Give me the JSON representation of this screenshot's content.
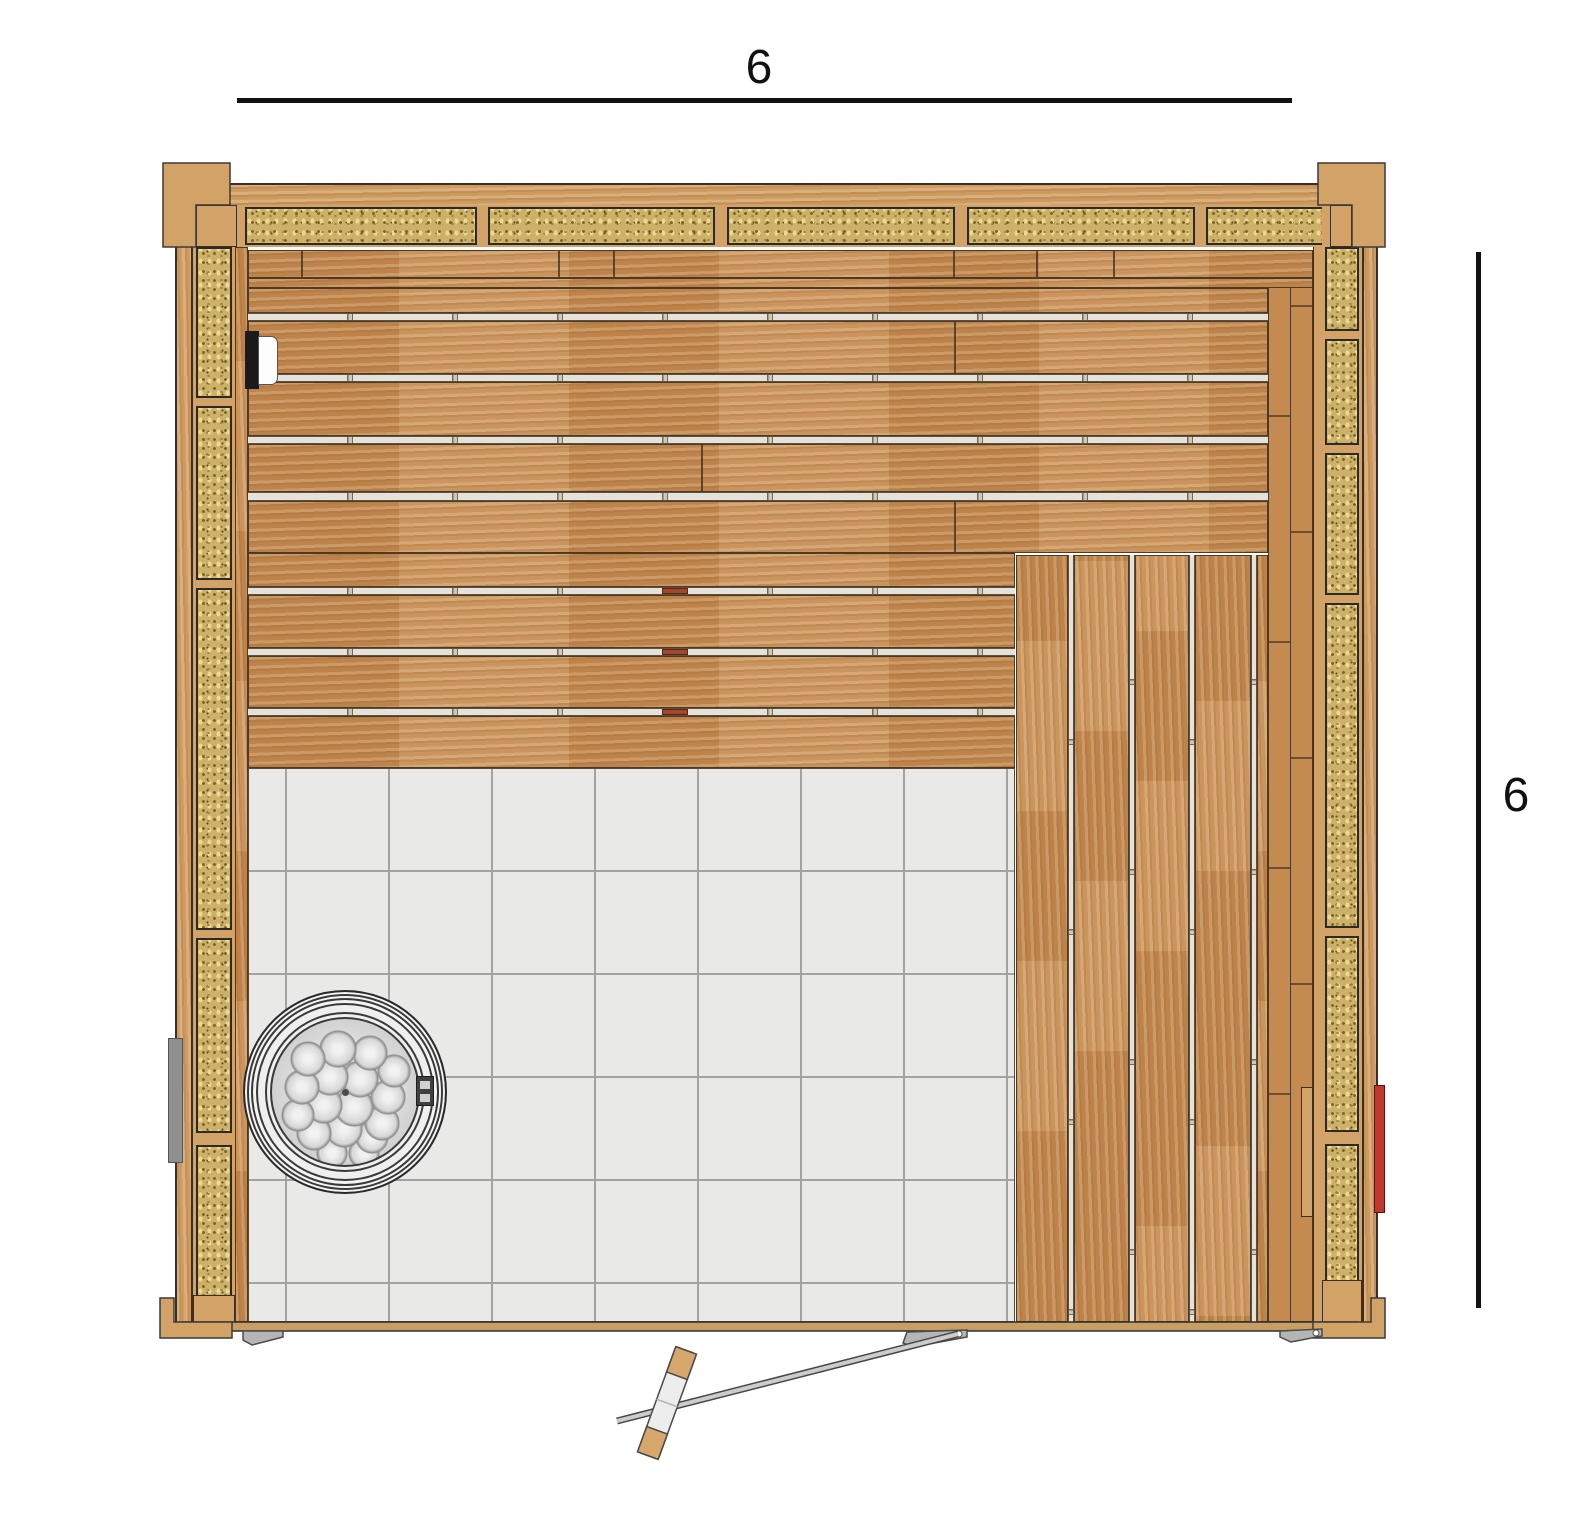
{
  "page": {
    "type": "sauna floor plan — top view",
    "background": "#ffffff"
  },
  "dimensions": {
    "top": {
      "label": "6"
    },
    "right": {
      "label": "6"
    }
  },
  "colors": {
    "bench_wood": "#c58a50",
    "frame_wood": "#cd9a60",
    "stud_tan": "#d2a267",
    "insulation_fill": "#cdb169",
    "insulation_speckle": "#7c6527",
    "outline_dark": "#3b2f23",
    "tile_fill": "#e9e9e7",
    "tile_grout": "#a2a2a0",
    "plank_gap": "#e6e2da",
    "stone_gray": "#d2d2d2",
    "glass_gray": "#cccccc",
    "clamp_gray": "#b5b5b5",
    "accent_red": "#c0392b",
    "utility_gray": "#8f8f8f"
  },
  "components": {
    "walls": [
      "top-wall",
      "left-wall",
      "right-wall"
    ],
    "front": "glass front wall with open door",
    "benches": [
      "upper-bench-horizontal-planks",
      "lower-bench-horizontal-planks",
      "side-bench-vertical-planks"
    ],
    "floor": "white tile floor",
    "equipment": [
      "round-stone-heater",
      "heater-control-box",
      "light-fixture",
      "power-box",
      "red-accent-strip"
    ],
    "door_hardware": [
      "glass-clamp-left",
      "glass-clamp-middle",
      "glass-clamp-right",
      "wood-capped-handle"
    ]
  },
  "insulation_panel_counts": {
    "top_wall": 5,
    "left_wall": 5,
    "right_wall": 6
  }
}
